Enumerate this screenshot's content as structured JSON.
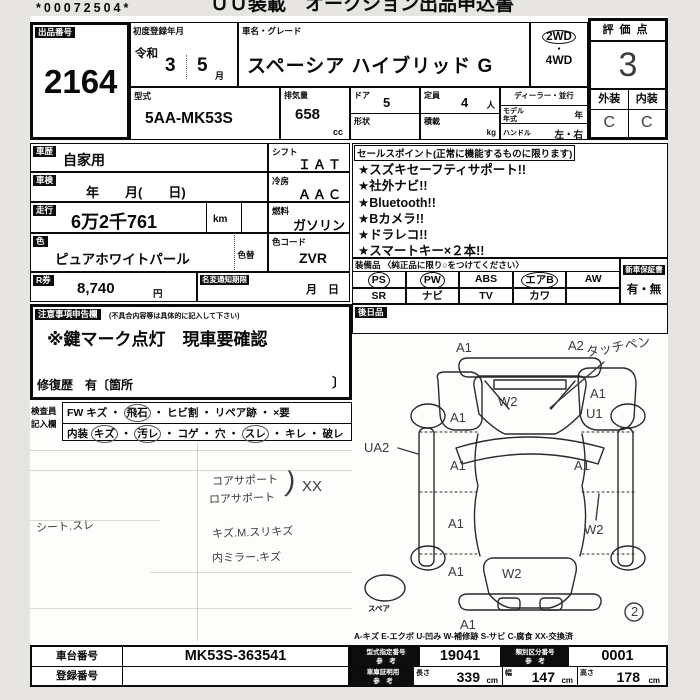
{
  "page": {
    "barcode": "*00072504*",
    "header_title": "ＵＵ装載　オークション出品申込書"
  },
  "top": {
    "lot": {
      "label": "出品番号",
      "value": "2164"
    },
    "first_reg": {
      "label": "初度登録年月",
      "era": "令和",
      "year": "3",
      "month": "5",
      "month_suffix": "月"
    },
    "car_name": {
      "label": "車名・グレード",
      "value": "スペーシア ハイブリッド G"
    },
    "drive": {
      "awd_top": "2WD",
      "dot": "・",
      "awd_bottom": "4WD"
    },
    "score": {
      "label": "評価点",
      "value": "3",
      "ext_label": "外装",
      "int_label": "内装",
      "ext_value": "C",
      "int_value": "C"
    },
    "model_code": {
      "label": "型式",
      "value": "5AA-MK53S"
    },
    "displacement": {
      "label": "排気量",
      "value": "658",
      "unit": "cc"
    },
    "doors": {
      "label": "ドア",
      "value": "5"
    },
    "shape": {
      "label": "形状"
    },
    "capacity": {
      "label": "定員",
      "value": "4",
      "unit": "人"
    },
    "load": {
      "label": "積載",
      "unit": "kg"
    },
    "dealer": {
      "label": "ディーラー・並行"
    },
    "model_year": {
      "label": "モデル年式",
      "unit": "年"
    },
    "handle": {
      "label": "ハンドル",
      "value": "左・右"
    }
  },
  "left": {
    "history": {
      "label": "車歴",
      "value": "自家用"
    },
    "inspection": {
      "label": "車検",
      "value": "年　　月(　　日)"
    },
    "mileage": {
      "label": "走行",
      "value": "6万2千761",
      "unit": "km"
    },
    "color": {
      "label": "色",
      "value": "ピュアホワイトパール",
      "change_label": "色替"
    },
    "color_code": {
      "label": "色コード",
      "value": "ZVR"
    },
    "shift": {
      "label": "シフト",
      "value": "ＩＡＴ"
    },
    "ac": {
      "label": "冷房",
      "value": "ＡＡＣ"
    },
    "fuel": {
      "label": "燃料",
      "value": "ガソリン"
    },
    "r_ticket": {
      "label": "R券",
      "value": "8,740",
      "unit": "円"
    },
    "name_change": {
      "label": "名変通知期限",
      "value": "月　日"
    }
  },
  "sales": {
    "header": "セールスポイント(正常に機能するものに限ります)",
    "items": [
      "★スズキセーフティサポート!!",
      "★社外ナビ!!",
      "★Bluetooth!!",
      "★Bカメラ!!",
      "★ドラレコ!!",
      "★スマートキー×２本!!"
    ]
  },
  "equipment": {
    "header": "装備品 〈純正品に限り○をつけてください〉",
    "rows": [
      [
        {
          "t": "PS",
          "c": true
        },
        {
          "t": "PW",
          "c": true
        },
        {
          "t": "ABS",
          "c": false
        },
        {
          "t": "エアB",
          "c": true
        },
        {
          "t": "AW",
          "c": false
        }
      ],
      [
        {
          "t": "SR",
          "c": false
        },
        {
          "t": "ナビ",
          "c": false
        },
        {
          "t": "TV",
          "c": false
        },
        {
          "t": "カワ",
          "c": false
        },
        {
          "t": "",
          "c": false
        }
      ]
    ],
    "warranty_label": "新車保証書",
    "warranty_value": "有・無"
  },
  "later": {
    "label": "後日品"
  },
  "caution": {
    "label": "注意事項申告欄",
    "note": "(不具合内容等は具体的に記入して下さい)",
    "body": "※鍵マーク点灯　現車要確認",
    "repair": "修復歴　有〔箇所",
    "bracket": "〕"
  },
  "inspector": {
    "side_label_1": "検査員",
    "side_label_2": "記入欄",
    "sep": "・",
    "rows": [
      {
        "items": [
          {
            "t": "FW",
            "c": false
          },
          {
            "t": "キズ",
            "c": false
          },
          {
            "t": "飛石",
            "c": true
          },
          {
            "t": "ヒビ割",
            "c": false
          },
          {
            "t": "リペア跡",
            "c": false
          },
          {
            "t": "×要",
            "c": false
          }
        ]
      },
      {
        "items": [
          {
            "t": "内装",
            "c": false
          },
          {
            "t": "キズ",
            "c": true
          },
          {
            "t": "汚レ",
            "c": true
          },
          {
            "t": "コゲ",
            "c": false
          },
          {
            "t": "穴",
            "c": false
          },
          {
            "t": "スレ",
            "c": true
          },
          {
            "t": "キレ",
            "c": false
          },
          {
            "t": "破レ",
            "c": false
          }
        ]
      }
    ]
  },
  "notes": {
    "core_support": "コアサポート",
    "lower_support": "ロアサポート",
    "support_bracket": ")",
    "support_xx": "XX",
    "seat": "シート.スレ",
    "scratch_line": "キズ.M.スリキズ",
    "mirror_line": "内ミラー.キズ"
  },
  "diagram": {
    "front_bumper_left": "A1",
    "front_bumper_right": "A2",
    "touch_note": "タッチペン",
    "windshield": "W2",
    "left_front_panel": "A1",
    "right_fender": "A1",
    "right_fender_sub": "U1",
    "left_rocker": "UA2",
    "front_door_left": "A1",
    "front_door_right": "A1",
    "rear_door_left": "A1",
    "rear_door_right": "W2",
    "rear_quarter_left": "A1",
    "tailgate": "W2",
    "rear_bumper": "A1",
    "sheet_circle": "2",
    "spare": "スペア",
    "legend": "A-キズ  E-エクボ  U-凹み  W-補修跡  S-サビ  C-腐食  XX-交換済"
  },
  "bottom": {
    "chassis": {
      "label": "車台番号",
      "value": "MK53S-363541"
    },
    "registration": {
      "label": "登録番号",
      "value": ""
    },
    "type_approval": {
      "label": "型式指定番号",
      "sub": "参　考",
      "value": "19041"
    },
    "class_number": {
      "label": "類別区分番号",
      "sub": "参　考",
      "value": "0001"
    },
    "garage": {
      "label": "車庫証明用",
      "sub": "参　考"
    },
    "length": {
      "label": "長さ",
      "value": "339",
      "unit": "cm"
    },
    "width": {
      "label": "幅",
      "value": "147",
      "unit": "cm"
    },
    "height": {
      "label": "高さ",
      "value": "178",
      "unit": "cm"
    }
  }
}
